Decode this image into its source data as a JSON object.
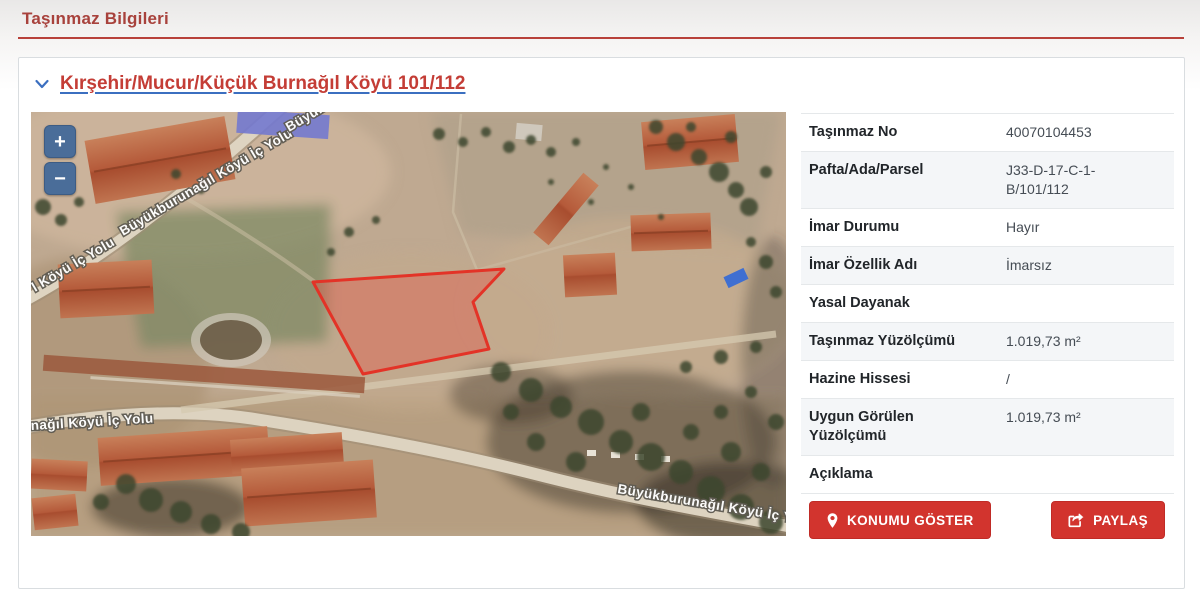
{
  "colors": {
    "title_red": "#a8423c",
    "rule_red": "#b8413a",
    "link_red": "#c43d36",
    "chevron_blue": "#3b6fc0",
    "map_control_blue": "#4a6d99",
    "button_red": "#d2342e",
    "parcel_red": "#e33327"
  },
  "page": {
    "title": "Taşınmaz Bilgileri"
  },
  "card": {
    "header": {
      "link_label": "Kırşehir/Mucur/Küçük Burnağıl Köyü 101/112"
    },
    "map": {
      "type": "satellite",
      "zoom_in_label": "+",
      "zoom_out_label": "−",
      "road_labels": [
        {
          "text": "l Köyü İç Yolu"
        },
        {
          "text": "Büyükburunağıl Köyü İç Yolu"
        },
        {
          "text": "Büyükburunağıl Köyü İç Yolu"
        },
        {
          "text": "nağıl Köyü İç Yolu"
        },
        {
          "text": "Büyükburunağıl Köyü İç Yolu"
        }
      ]
    },
    "details": {
      "rows": [
        {
          "label": "Taşınmaz No",
          "value": "40070104453"
        },
        {
          "label": "Pafta/Ada/Parsel",
          "value": "J33-D-17-C-1-B/101/112"
        },
        {
          "label": "İmar Durumu",
          "value": "Hayır"
        },
        {
          "label": "İmar Özellik Adı",
          "value": "İmarsız"
        },
        {
          "label": "Yasal Dayanak",
          "value": ""
        },
        {
          "label": "Taşınmaz Yüzölçümü",
          "value": "1.019,73 m²"
        },
        {
          "label": "Hazine Hissesi",
          "value": "/"
        },
        {
          "label": "Uygun Görülen Yüzölçümü",
          "value": "1.019,73 m²"
        },
        {
          "label": "Açıklama",
          "value": ""
        }
      ],
      "buttons": [
        {
          "label": "KONUMU GÖSTER",
          "icon": "map-pin-icon"
        },
        {
          "label": "PAYLAŞ",
          "icon": "share-icon"
        }
      ]
    }
  }
}
